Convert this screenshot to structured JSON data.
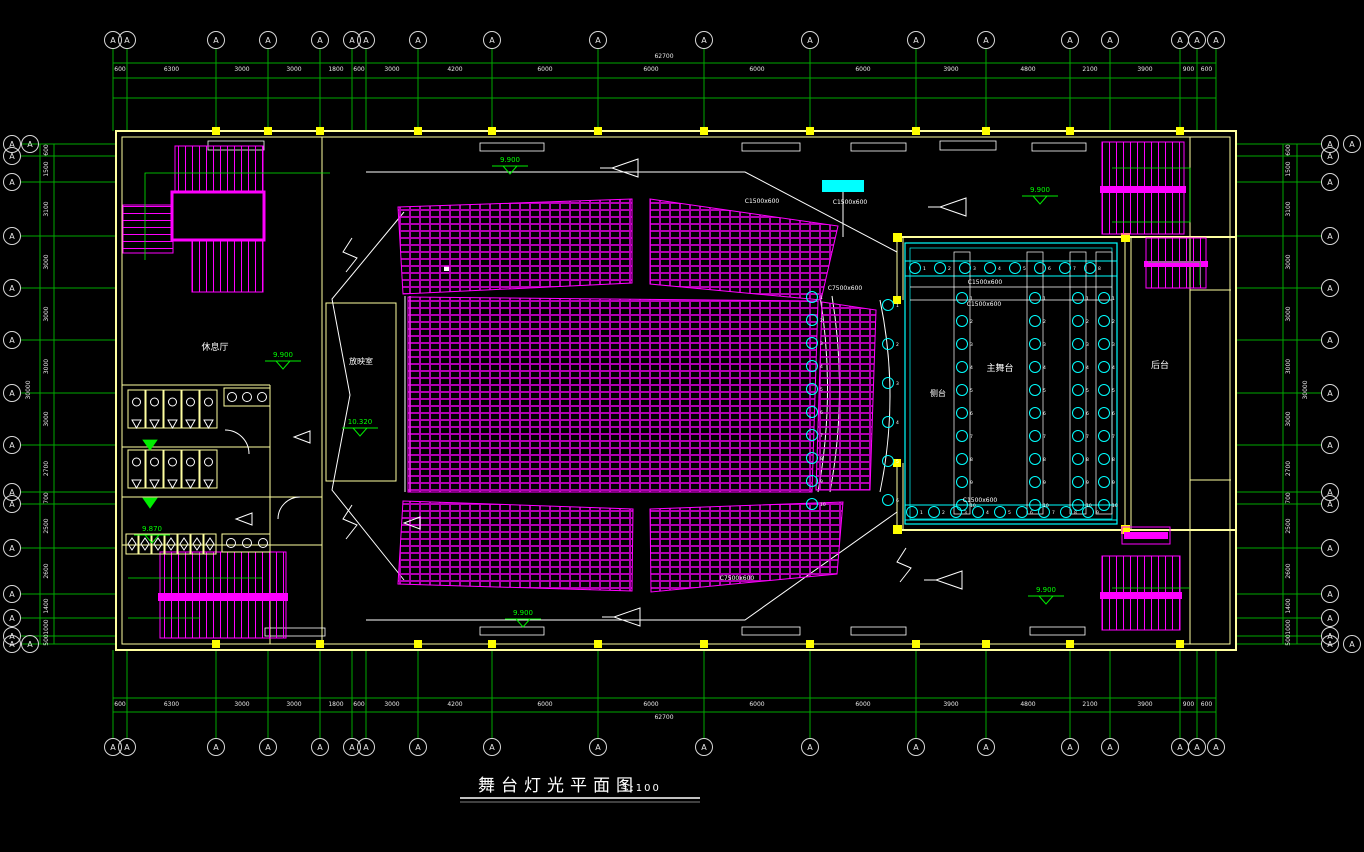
{
  "title": {
    "text": "舞台灯光平面图",
    "scale": "1:100"
  },
  "rooms": {
    "lounge": "休息厅",
    "projection": "放映室",
    "side_stage": "侧台",
    "main_stage": "主舞台",
    "backstage": "后台"
  },
  "colors": {
    "axis_green": "#00a800",
    "marker_green": "#00ee00",
    "wall_yellow": "#ffffa0",
    "column_yellow": "#ffff00",
    "seat_magenta": "#ff00ff",
    "stage_cyan": "#00ffff",
    "line_white": "#ffffff",
    "background": "#000000"
  },
  "grid": {
    "bubble_label": "A",
    "overall_width": "62700",
    "overall_height": "30000",
    "top": {
      "xs": [
        113,
        127,
        216,
        268,
        320,
        352,
        366,
        418,
        492,
        598,
        704,
        810,
        916,
        986,
        1070,
        1110,
        1180,
        1197,
        1216
      ],
      "dims": [
        "600",
        "6300",
        "3000",
        "3000",
        "1800",
        "600",
        "3000",
        "4200",
        "6000",
        "6000",
        "6000",
        "6000",
        "3900",
        "4800",
        "2100",
        "3900",
        "900",
        "600"
      ]
    },
    "left": {
      "ys": [
        144,
        156,
        182,
        236,
        288,
        340,
        393,
        445,
        492,
        504,
        548,
        594,
        618,
        636,
        644
      ],
      "dims": [
        "600",
        "1500",
        "3100",
        "3000",
        "3000",
        "3000",
        "3000",
        "2700",
        "700",
        "2500",
        "2600",
        "1400",
        "1000",
        "500"
      ]
    }
  },
  "lights": {
    "rows": [
      {
        "y": 268,
        "x0": 915,
        "dx": 25,
        "n": 8
      },
      {
        "y": 512,
        "x0": 912,
        "dx": 22,
        "n": 9
      }
    ],
    "cols": [
      {
        "x": 812,
        "y0": 297,
        "dy": 23,
        "n": 10
      },
      {
        "x": 888,
        "y0": 305,
        "dy": 39,
        "n": 6
      },
      {
        "x": 962,
        "y0": 298,
        "dy": 23,
        "n": 10
      },
      {
        "x": 1035,
        "y0": 298,
        "dy": 23,
        "n": 10
      },
      {
        "x": 1078,
        "y0": 298,
        "dy": 23,
        "n": 10
      },
      {
        "x": 1104,
        "y0": 298,
        "dy": 23,
        "n": 10
      }
    ]
  },
  "annotations": {
    "elevations": [
      {
        "x": 510,
        "y": 162,
        "v": "9.900"
      },
      {
        "x": 1040,
        "y": 192,
        "v": "9.900"
      },
      {
        "x": 283,
        "y": 357,
        "v": "9.900"
      },
      {
        "x": 152,
        "y": 531,
        "v": "9.870"
      },
      {
        "x": 360,
        "y": 424,
        "v": "10.320"
      },
      {
        "x": 1046,
        "y": 592,
        "v": "9.900"
      },
      {
        "x": 523,
        "y": 615,
        "v": "9.900"
      }
    ],
    "labels": [
      {
        "x": 762,
        "y": 203,
        "v": "C1500x600"
      },
      {
        "x": 850,
        "y": 204,
        "v": "C1500x600"
      },
      {
        "x": 985,
        "y": 284,
        "v": "C1500x600"
      },
      {
        "x": 984,
        "y": 306,
        "v": "C1500x600"
      },
      {
        "x": 845,
        "y": 290,
        "v": "C7500x600"
      },
      {
        "x": 737,
        "y": 580,
        "v": "C7500x600"
      },
      {
        "x": 980,
        "y": 502,
        "v": "C1500x600"
      }
    ]
  }
}
